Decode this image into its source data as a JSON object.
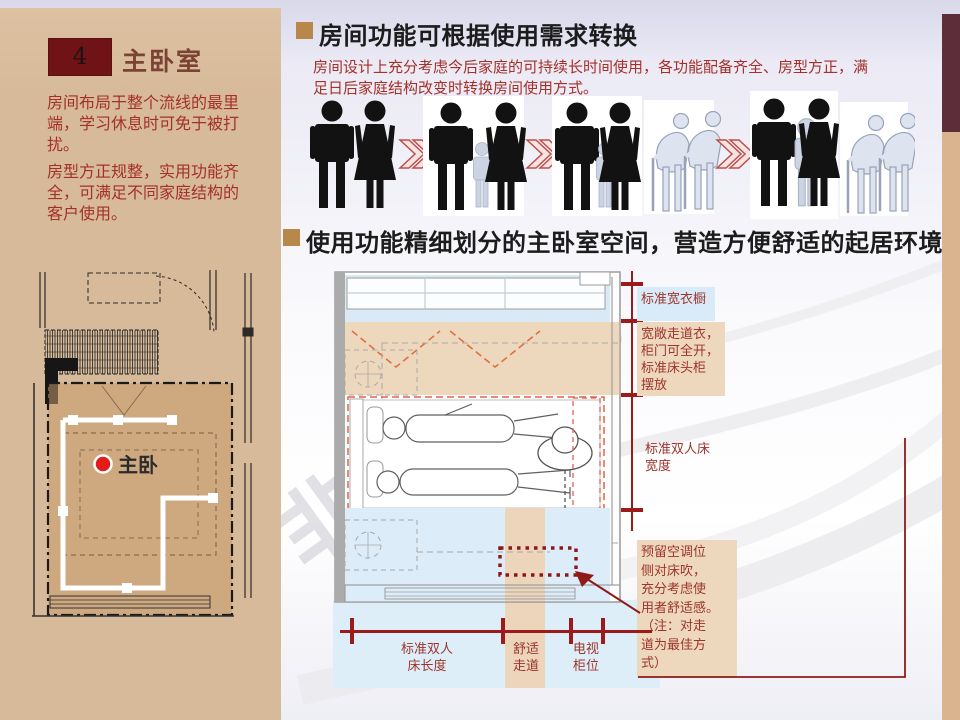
{
  "sidebar": {
    "number": "4",
    "title": "主卧室",
    "paragraphs": [
      "房间布局于整个流线的最里\n端，学习休息时可免于被打\n扰。",
      "房型方正规整，实用功能齐\n全，可满足不同家庭结构的\n客户使用。"
    ],
    "plan_room_label": "主卧"
  },
  "main": {
    "section1": {
      "title": "房间功能可根据使用需求转换",
      "body": "房间设计上充分考虑今后家庭的可持续长时间使用，各功能配备齐全、房型方正，满\n足日后家庭结构改变时转换房间使用方式。"
    },
    "figure_row": {
      "stages": [
        "couple",
        "couple-with-child",
        "family-with-child-and-elderly",
        "extended-family-with-elderly"
      ],
      "arrow_glyph": "≫"
    },
    "section2": {
      "title": "使用功能精细划分的主卧室空间，营造方便舒适的起居环境"
    },
    "annotations": {
      "wardrobe": "标准宽衣橱",
      "walkway": "宽敞走道衣，\n柜门可全开，\n标准床头柜\n摆放",
      "bed_width": "标准双人床\n宽度",
      "ac": "预留空调位\n侧对床吹，\n充分考虑使\n用者舒适感。\n（注：对走\n道为最佳方\n式）",
      "bed_length": "标准双人\n床长度",
      "comfort_walkway": "舒适\n走道",
      "tv": "电视\n柜位"
    }
  },
  "watermark": "非房水印",
  "colors": {
    "sidebar_tan": "#d7ba99",
    "number_box": "#6f1317",
    "accent_red": "#9b1b1b",
    "body_red": "#a4302a",
    "bullet_gold": "#b8874b",
    "band_tan": "#eed8bd",
    "band_blue": "#d9eaf6",
    "edge_maroon": "#5d2e39",
    "edge_tan": "#d9b48f"
  }
}
